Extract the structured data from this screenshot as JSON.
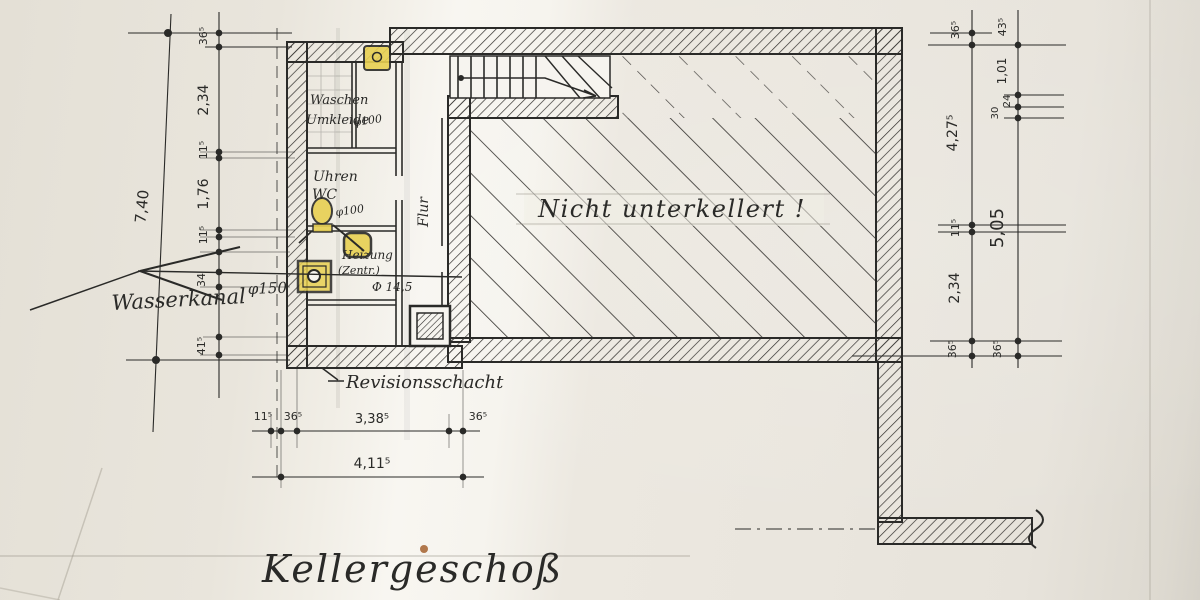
{
  "drawing": {
    "title": "Kellergeschoß",
    "area_label": "Nicht unterkellert !",
    "rooms": {
      "waschen": "Waschen",
      "umkleide": "Umkleide",
      "wc_line1": "Uhren",
      "wc_line2": "WC",
      "flur": "Flur",
      "heizung_line1": "Heizung",
      "heizung_line2": "(Zentr.)"
    },
    "annotations": {
      "revisionsschacht": "Revisionsschacht",
      "wasserkanal": "Wasserkanal",
      "phi_150": "φ150",
      "phi_100_umkleide": "φ100",
      "phi_100_wc": "φ100",
      "phi_145": "Φ 14,5"
    },
    "dimensions": {
      "left_total": "7,40",
      "left_chain": [
        "36⁵",
        "2,34",
        "11⁵",
        "1,76",
        "11⁵",
        "34",
        "41⁵"
      ],
      "bottom_chain": [
        "11⁵",
        "36⁵",
        "3,38⁵",
        "36⁵"
      ],
      "bottom_total": "4,11⁵",
      "right_inner_chain": [
        "36⁵",
        "4,27⁵",
        "11⁵",
        "2,34",
        "36⁵"
      ],
      "right_outer_chain": [
        "43⁵",
        "1,01",
        "24",
        "30",
        "5,05",
        "36⁵"
      ]
    },
    "colors": {
      "ink": "#2a2a28",
      "paper": "#e9e5dc",
      "paper_light": "#f8f6f1",
      "highlight_yellow": "#e8d052",
      "pencil": "#8f8a80"
    }
  }
}
